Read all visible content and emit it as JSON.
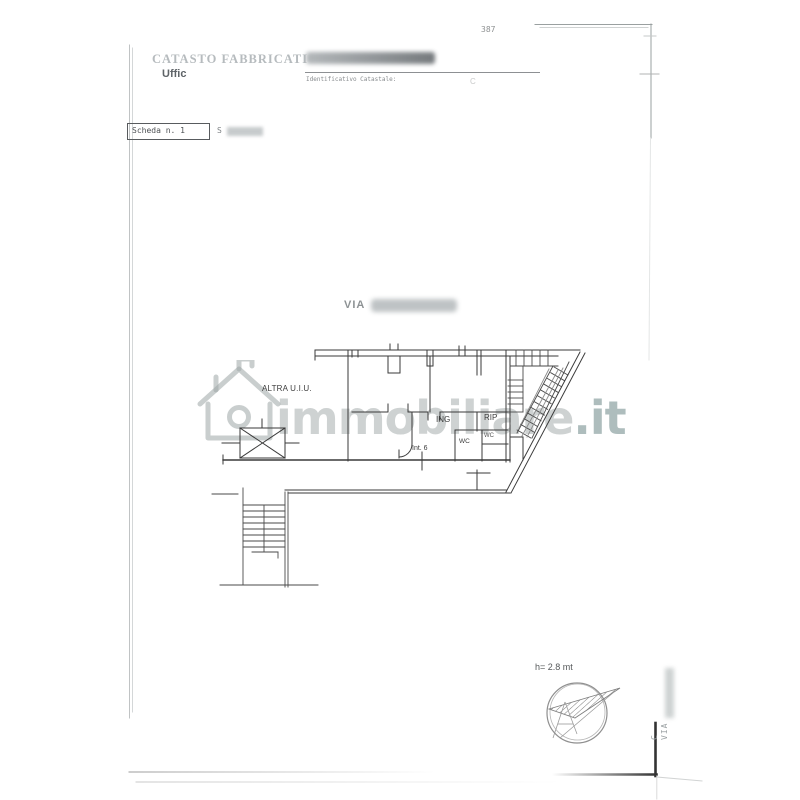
{
  "document": {
    "page_number": "387",
    "header": {
      "registry": "CATASTO FABBRICATI",
      "office": "Uffic",
      "identifier_label": "Identificativo Catastale:",
      "identifier_faint": "C"
    },
    "scheda": {
      "label": "Scheda n. 1",
      "scale_prefix": "S"
    },
    "address": {
      "prefix": "VIA"
    }
  },
  "plan": {
    "labels": {
      "other_unit": "ALTRA U.I.U.",
      "entrance": "ING",
      "storage": "RIP",
      "wc_small": "WC",
      "wc": "WC",
      "internal_number": "Int. 6",
      "ceiling_height": "h= 2.8 mt"
    }
  },
  "side_annotation": {
    "line1": "C",
    "line2": "VIA"
  },
  "watermark": {
    "brand": "immobiliare",
    "tld": ".it"
  },
  "colors": {
    "ink": "#3a3a3a",
    "faded_ink": "#b6bbbe",
    "watermark": "#9da6a6",
    "frame": "#9aa0a0",
    "corner": "#333333"
  }
}
